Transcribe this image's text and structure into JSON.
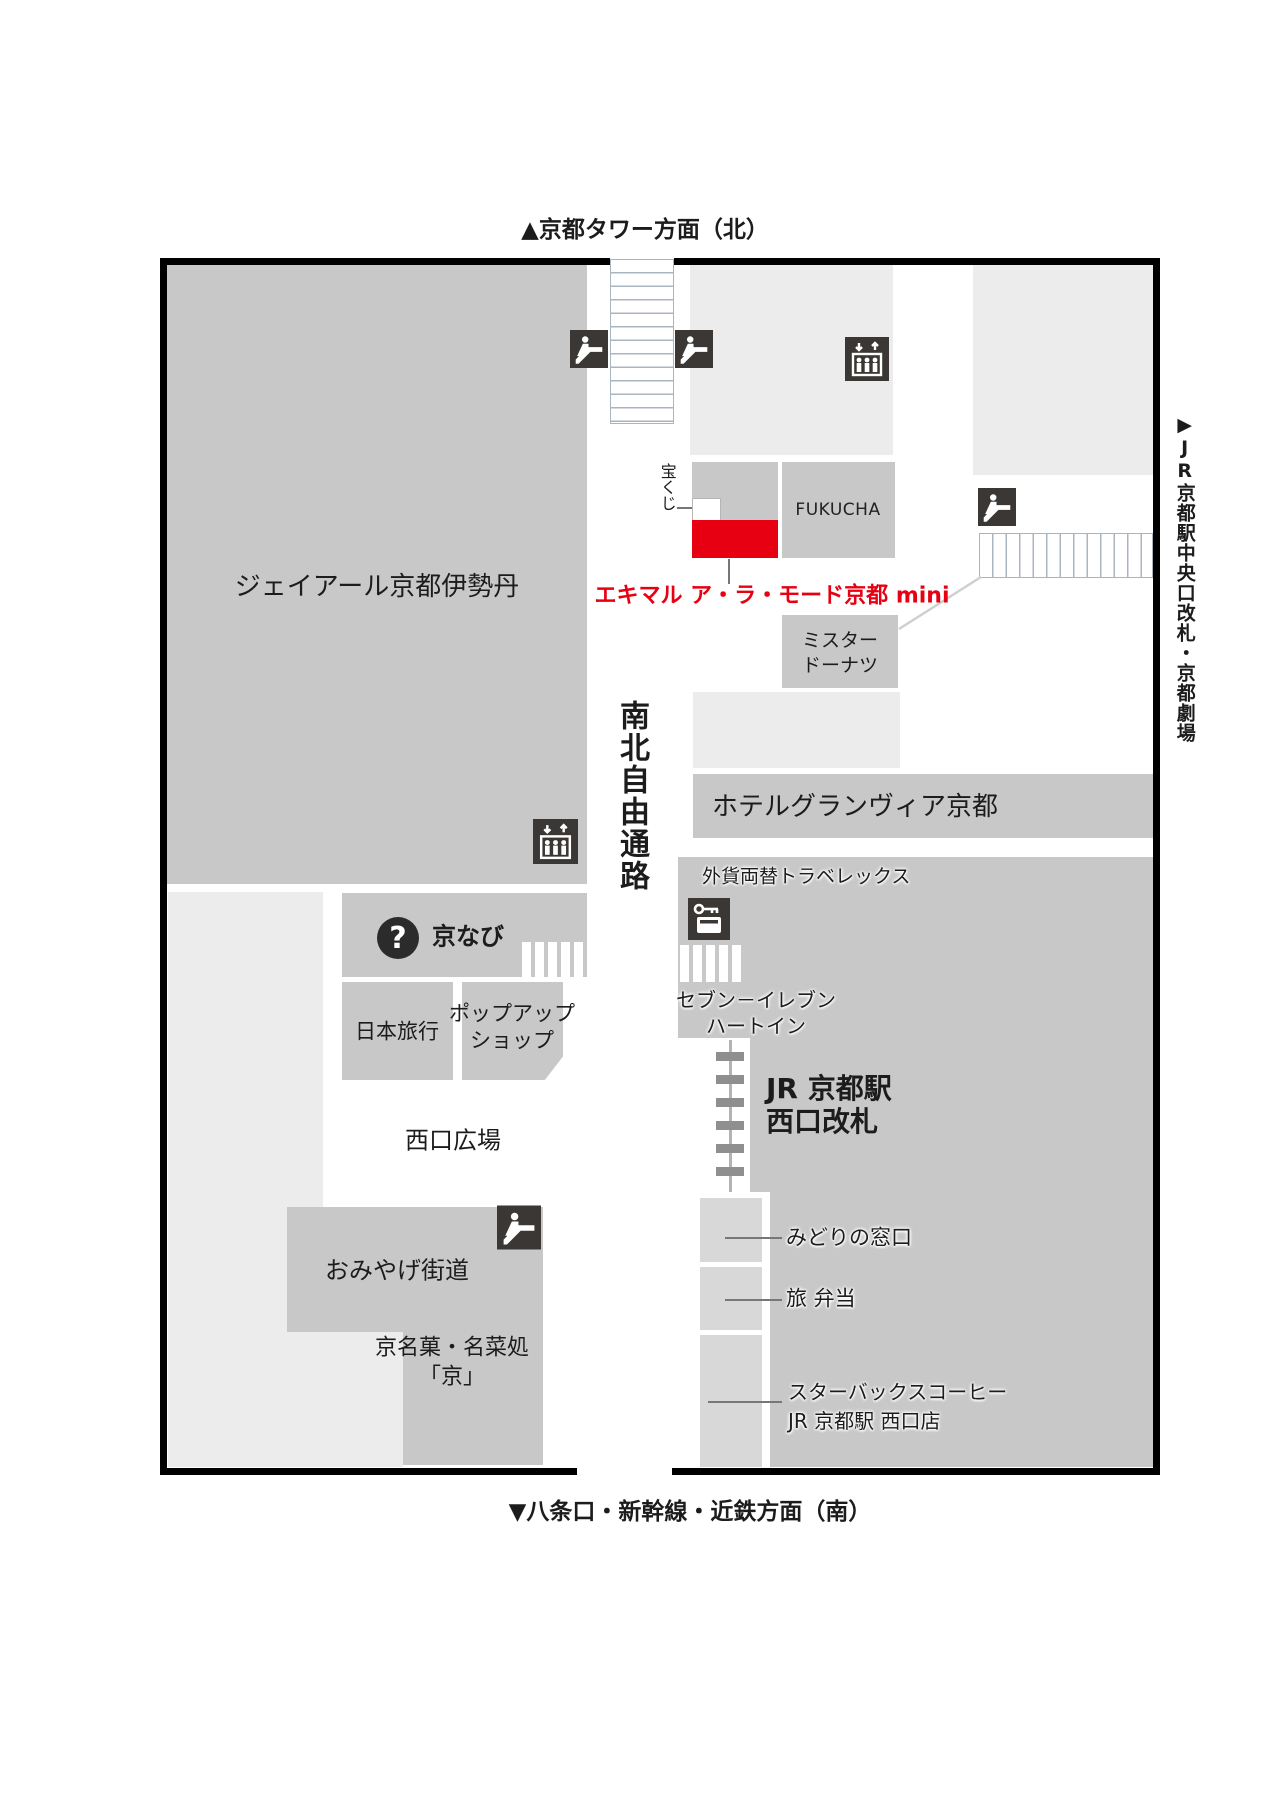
{
  "title": "JR Kyoto Station West Gate area floor map",
  "colors": {
    "block_gray": "#c8c8c8",
    "light_gray": "#ececec",
    "panel_gray": "#d8d8d8",
    "accent_red": "#e60012",
    "icon_dark": "#3a3734",
    "stair_line": "#a9b6c0",
    "text": "#1c1c1c"
  },
  "compass": {
    "north": "▲京都タワー方面（北）",
    "south": "▼八条口・新幹線・近鉄方面（南）",
    "east": "▶JR京都駅中央口改札・京都劇場"
  },
  "areas": {
    "isetan": "ジェイアール京都伊勢丹",
    "corridor": "南北自由通路",
    "takarakuji": "宝くじ",
    "fukucha": "FUKUCHA",
    "ekimaru": "エキマル ア・ラ・モード京都 mini",
    "donut_line1": "ミスター",
    "donut_line2": "ドーナツ",
    "hotel": "ホテルグランヴィア京都",
    "travelex": "外貨両替トラベレックス",
    "seven_line1": "セブン－イレブン",
    "seven_line2": "ハートイン",
    "gate_line1": "JR 京都駅",
    "gate_line2": "西口改札",
    "midori": "みどりの窓口",
    "bento": "旅 弁当",
    "starbucks_line1": "スターバックスコーヒー",
    "starbucks_line2": "JR 京都駅 西口店",
    "kyonavi": "京なび",
    "nihon_ryoko": "日本旅行",
    "popup_line1": "ポップアップ",
    "popup_line2": "ショップ",
    "hiroba": "西口広場",
    "omiyage": "おみやげ街道",
    "kyomeika_line1": "京名菓・名菜処",
    "kyomeika_line2": "「京」"
  },
  "icons": {
    "question_glyph": "?"
  }
}
